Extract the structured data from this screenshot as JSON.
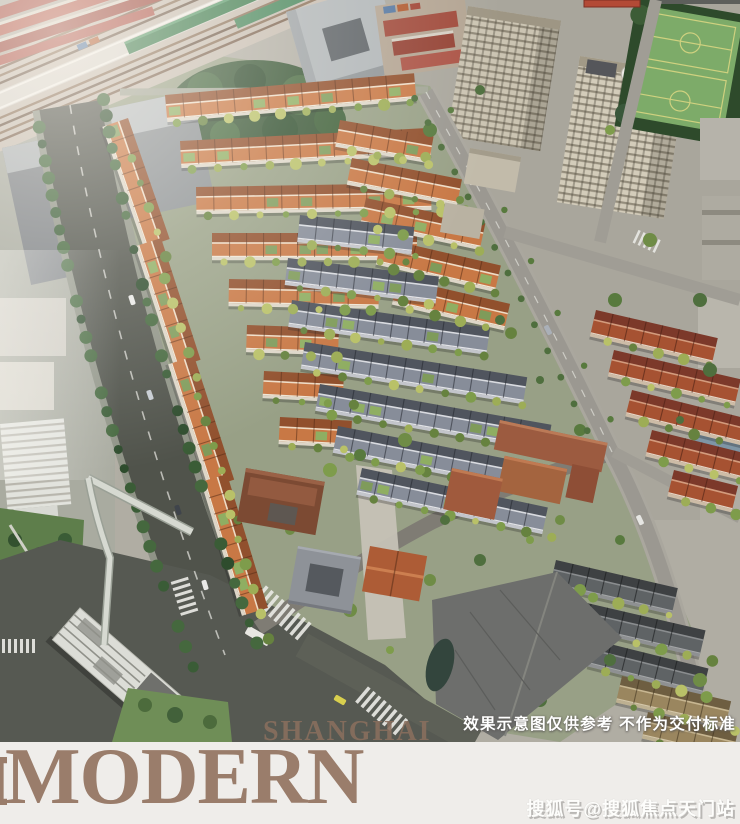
{
  "image": {
    "disclaimer": "效果示意图仅供参考 不作为交付标准",
    "watermark": "搜狐号@搜狐焦点天门站"
  },
  "branding": {
    "top_word": "SHANGHAI",
    "bottom_word": "MODERN"
  },
  "colors": {
    "brand_brown": "#9a7d6b",
    "band_background": "#efedea",
    "caption_white": "#ffffff",
    "watermark_white": "#fdfdfb",
    "roof_orange": "#c87845",
    "roof_gray": "#878d99",
    "roof_brick": "#a65232",
    "roof_dark": "#5f6365",
    "roof_tan": "#9a865f",
    "tree_green": "#7e9c4b",
    "boulevard_tree_green": "#3a5c36",
    "field_green": "#7dab69",
    "asphalt": "#50534b",
    "massing_gray": "#8b9093",
    "tower_beige": "#cbc4b2"
  }
}
